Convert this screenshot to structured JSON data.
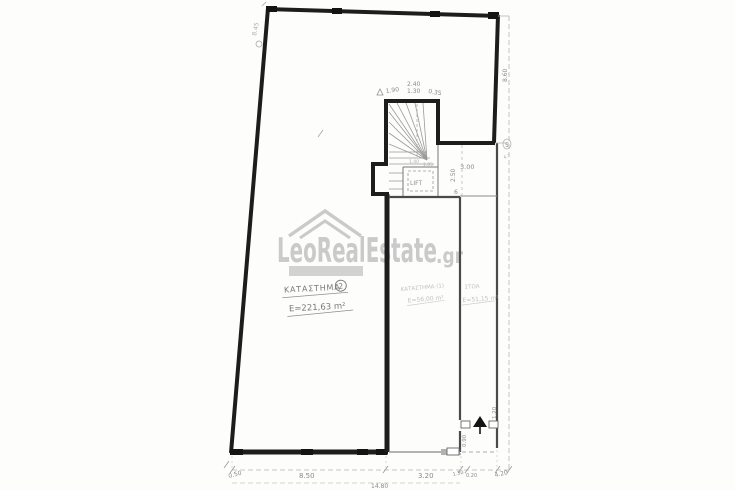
{
  "watermark": {
    "brand": "LeoRealEstate",
    "tld": ".gr"
  },
  "rooms": {
    "shop2": {
      "name": "ΚΑΤΑΣΤΗΜΑ",
      "number": "2",
      "area": "Ε=221,63 m²"
    },
    "shop1": {
      "name": "ΚΑΤΑΣΤΗΜΑ (1)",
      "area": "Ε=56,00 m²"
    },
    "stoa": {
      "name": "ΣΤΟΑ",
      "area": "Ε=51,15 m²"
    },
    "lift": {
      "name": "LIFT"
    }
  },
  "dims": [
    "0.50",
    "8.50",
    "14.80",
    "3.20",
    "1.30",
    "0.20",
    "4.20",
    "8.60",
    "8.45",
    "1.90",
    "2.40",
    "1.30",
    "0.35",
    "3.00",
    "2.50",
    "1.40",
    "1.05",
    "0.90",
    "1.20",
    "6",
    "5",
    "4.7"
  ],
  "colors": {
    "wall": "#1d1d1d",
    "pencil": "#8a8a8a",
    "watermark": "#c6c6c6"
  }
}
